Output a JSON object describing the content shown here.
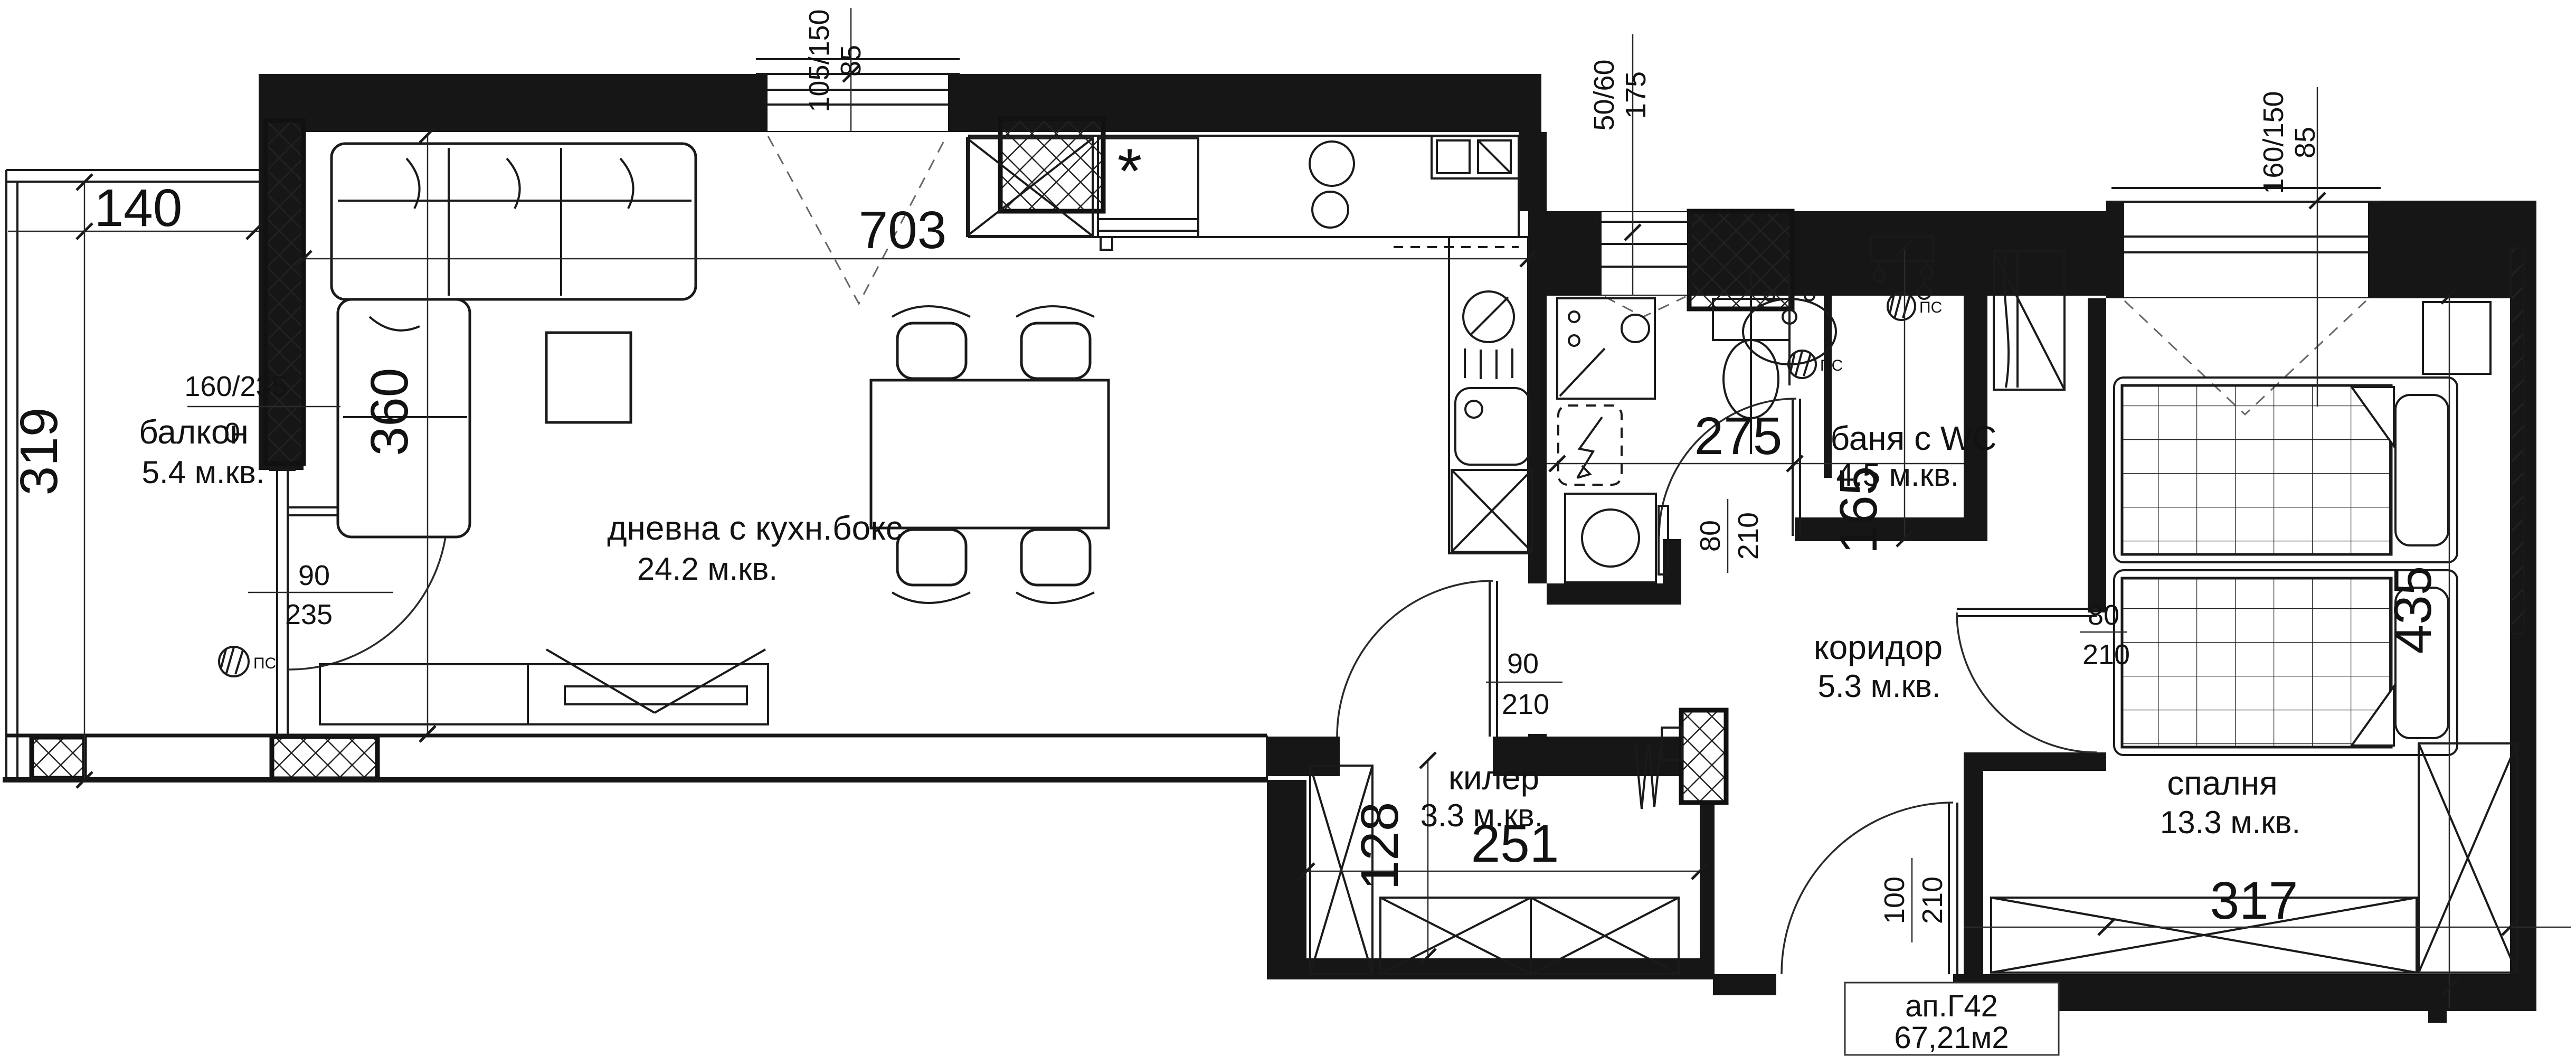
{
  "plan": {
    "apartment": {
      "label": "ап.Г42",
      "area": "67,21м2"
    },
    "vent": "ПС",
    "rooms": [
      {
        "name": "балкон",
        "area": "5.4 м.кв."
      },
      {
        "name": "дневна с кухн.бокс",
        "area": "24.2 м.кв."
      },
      {
        "name": "баня с WC",
        "area": "4.5 м.кв."
      },
      {
        "name": "килер",
        "area": "3.3 м.кв."
      },
      {
        "name": "коридор",
        "area": "5.3 м.кв."
      },
      {
        "name": "спалня",
        "area": "13.3 м.кв."
      }
    ],
    "dims": {
      "d140": "140",
      "d319": "319",
      "d360": "360",
      "d703": "703",
      "d275": "275",
      "d165": "165",
      "d251": "251",
      "d128": "128",
      "d317": "317",
      "d435": "435"
    },
    "openings": {
      "balcony_door_size": "160/235",
      "balcony_door_sill": "0",
      "living_window_size": "105/150",
      "living_window_sill": "85",
      "balcony_exit_w": "90",
      "balcony_exit_h": "235",
      "bath_window_size": "50/60",
      "bath_window_sill": "175",
      "bedroom_window_size": "160/150",
      "bedroom_window_sill": "85",
      "storage_door_w": "90",
      "storage_door_h": "210",
      "bath_door_w": "80",
      "bath_door_h": "210",
      "bedroom_door_w": "80",
      "bedroom_door_h": "210",
      "entrance_door_w": "100",
      "entrance_door_h": "210"
    }
  }
}
